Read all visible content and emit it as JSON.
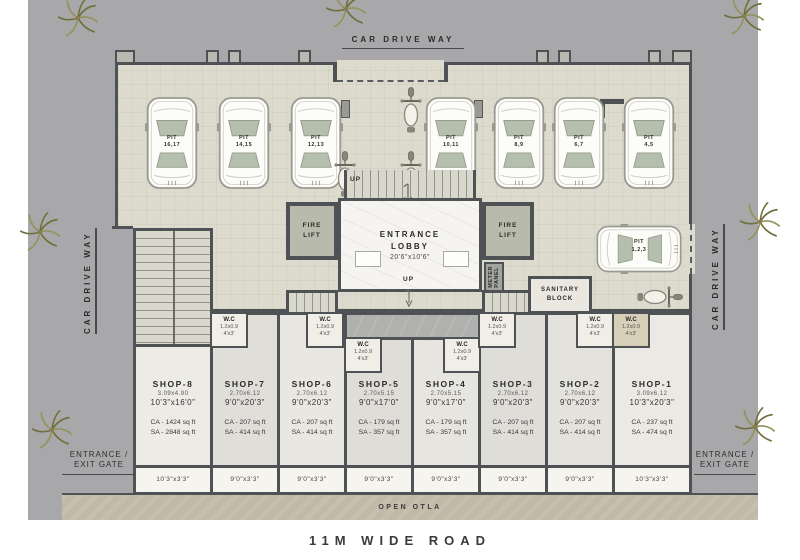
{
  "labels": {
    "driveway": "CAR DRIVE WAY",
    "road": "11M WIDE ROAD",
    "otla": "OPEN OTLA",
    "up": "UP",
    "gate_line1": "ENTRANCE /",
    "gate_line2": "EXIT GATE"
  },
  "lobby": {
    "line1": "ENTRANCE",
    "line2": "LOBBY",
    "size": "20'6\"x10'6\""
  },
  "fire_lift": {
    "line1": "FIRE",
    "line2": "LIFT"
  },
  "meter_panel": {
    "line1": "METER",
    "line2": "PANEL"
  },
  "sanitary": {
    "line1": "SANITARY",
    "line2": "BLOCK"
  },
  "wc": {
    "label": "W.C",
    "metric": "1.2x0.9",
    "imperial": "4'x3'"
  },
  "cars": [
    {
      "word": "PIT",
      "nums": "16,17"
    },
    {
      "word": "PIT",
      "nums": "14,15"
    },
    {
      "word": "PIT",
      "nums": "12,13"
    },
    {
      "word": "PIT",
      "nums": "10,11"
    },
    {
      "word": "PIT",
      "nums": "8,9"
    },
    {
      "word": "PIT",
      "nums": "6,7"
    },
    {
      "word": "PIT",
      "nums": "4,5"
    },
    {
      "word": "PIT",
      "nums": "1,2,3"
    }
  ],
  "shops": [
    {
      "name": "SHOP-8",
      "metric": "3.09x4.90",
      "imperial": "10'3\"x16'0\"",
      "ca": "CA - 1424 sq ft",
      "sa": "SA - 2848 sq ft",
      "veranda": "10'3\"x3'3\""
    },
    {
      "name": "SHOP-7",
      "metric": "2.70x6.12",
      "imperial": "9'0\"x20'3\"",
      "ca": "CA - 207 sq ft",
      "sa": "SA - 414 sq ft",
      "veranda": "9'0\"x3'3\""
    },
    {
      "name": "SHOP-6",
      "metric": "2.70x6.12",
      "imperial": "9'0\"x20'3\"",
      "ca": "CA - 207 sq ft",
      "sa": "SA - 414 sq ft",
      "veranda": "9'0\"x3'3\""
    },
    {
      "name": "SHOP-5",
      "metric": "2.70x5.15",
      "imperial": "9'0\"x17'0\"",
      "ca": "CA - 179 sq ft",
      "sa": "SA - 357 sq ft",
      "veranda": "9'0\"x3'3\""
    },
    {
      "name": "SHOP-4",
      "metric": "2.70x5.15",
      "imperial": "9'0\"x17'0\"",
      "ca": "CA - 179 sq ft",
      "sa": "SA - 357 sq ft",
      "veranda": "9'0\"x3'3\""
    },
    {
      "name": "SHOP-3",
      "metric": "2.70x6.12",
      "imperial": "9'0\"x20'3\"",
      "ca": "CA - 207 sq ft",
      "sa": "SA - 414 sq ft",
      "veranda": "9'0\"x3'3\""
    },
    {
      "name": "SHOP-2",
      "metric": "2.70x6.12",
      "imperial": "9'0\"x20'3\"",
      "ca": "CA - 207 sq ft",
      "sa": "SA - 414 sq ft",
      "veranda": "9'0\"x3'3\""
    },
    {
      "name": "SHOP-1",
      "metric": "3.09x6.12",
      "imperial": "10'3\"x20'3\"",
      "ca": "CA - 237 sq ft",
      "sa": "SA - 474 sq ft",
      "veranda": "10'3\"x3'3\""
    }
  ]
}
